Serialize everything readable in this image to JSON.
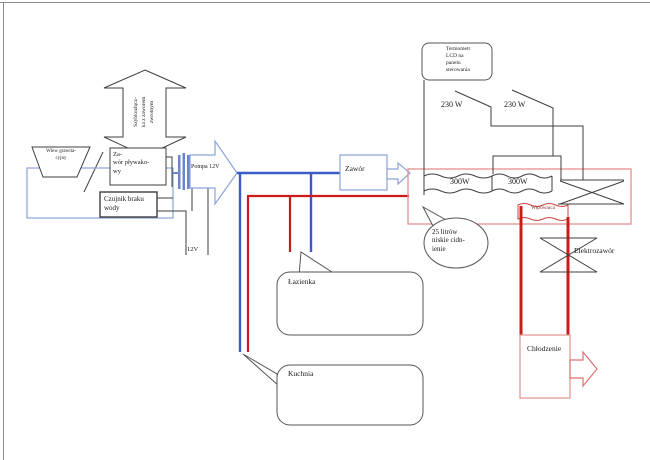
{
  "colors": {
    "pipe_cold": "#3b5bc7",
    "pipe_hot": "#cc1a1a",
    "outline_light_blue": "#8ba4d8",
    "pump_bar": "#6b87cc",
    "tank_outline": "#e4908f",
    "coil_outline": "#cc4444",
    "arrow_out": "#e07070",
    "wire": "#3f3f3f",
    "callout": "#555555",
    "page_border": "#8a8a8a",
    "text": "#1a1a1a",
    "wezownica_text": "#7a2c20"
  },
  "diagram": {
    "left": {
      "wlew_grawitacyjny": "Wlew grawita-\ncyjny",
      "szybkozlaczka": "Szybkozłącz-\nka z zaworem\nzwrotnym",
      "zawor_plywakowy": "Za-\nwór pływako-\nwy",
      "czujnik_braku_wody": "Czujnik braku\nwody",
      "pompa": "Pompa 12V",
      "zasilanie": "12V"
    },
    "middle": {
      "zawor": "Zawór",
      "lazienka": "Łazienka",
      "kuchnia": "Kuchnia"
    },
    "tank": {
      "termometr": "Termometr\nLCD na\npanelu\nsterowania",
      "moc_grzalki_1": "230 W",
      "moc_grzalki_2": "230 W",
      "grzalka_1": "300W",
      "grzalka_2": "300W",
      "wezownica": "Węzownica",
      "pojemnosc": "25 litrów\nniskie cidn-\nienie"
    },
    "right": {
      "elektrozawor": "Elektrozawór",
      "chlodzenie": "Chłodzenie"
    }
  }
}
